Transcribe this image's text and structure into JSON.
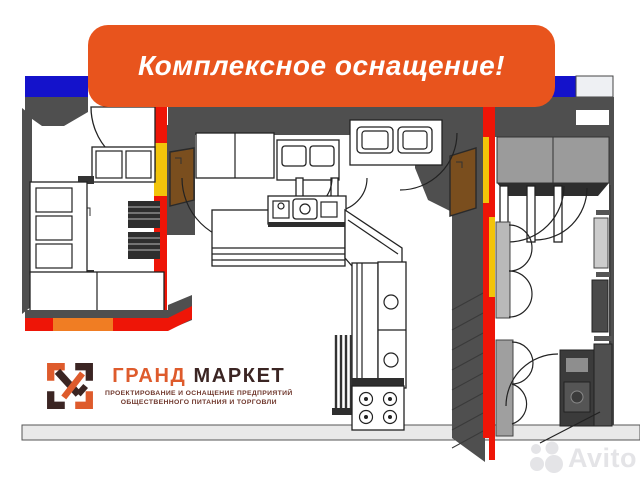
{
  "banner": {
    "text": "Комплексное оснащение!"
  },
  "logo": {
    "title_part1": "ГРАНД",
    "title_part2": "МАРКЕТ",
    "subtitle_line1": "ПРОЕКТИРОВАНИЕ И ОСНАЩЕНИЕ ПРЕДПРИЯТИЙ",
    "subtitle_line2": "ОБЩЕСТВЕННОГО ПИТАНИЯ И ТОРГОВЛИ"
  },
  "watermark": {
    "text": "Avito"
  },
  "palette": {
    "banner_orange": "#E8541D",
    "plan_blue": "#1412CB",
    "plan_red": "#EE1507",
    "plan_yellow": "#F2C40A",
    "plan_orange": "#F07D23",
    "door_brown": "#7A4E1E",
    "wall_dark": "#4F4F4F",
    "wall_mid": "#9B9B9B",
    "floor_gray": "#E9E9E9",
    "logo_orange": "#DE5B2C",
    "logo_dark": "#3B2523",
    "subtitle_maroon": "#6F372C",
    "watermark_gray": "#E4E4E7"
  }
}
